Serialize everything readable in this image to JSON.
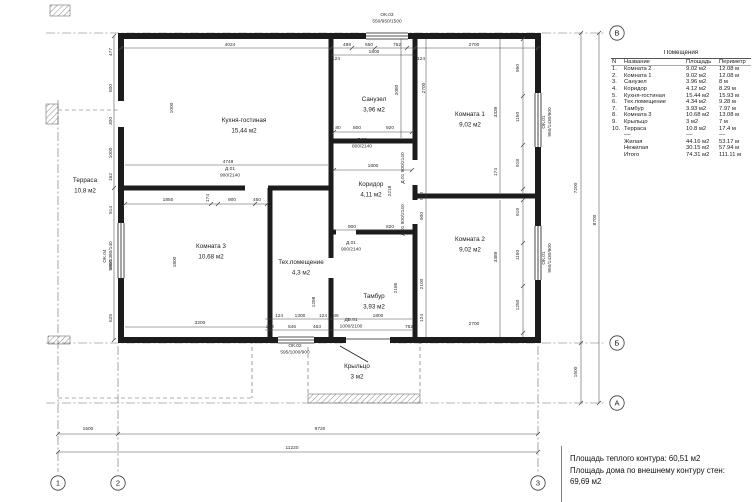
{
  "legend": {
    "title": "Помещения",
    "headers": {
      "num": "N",
      "name": "Название",
      "area": "Площадь",
      "perimeter": "Периметр"
    },
    "rows": [
      {
        "n": "1.",
        "name": "Комната 2",
        "area": "9.02 м2",
        "perimeter": "12.08 м"
      },
      {
        "n": "2.",
        "name": "Комната 1",
        "area": "9.02 м2",
        "perimeter": "12.08 м"
      },
      {
        "n": "3.",
        "name": "Санузел",
        "area": "3.96 м2",
        "perimeter": "8 м"
      },
      {
        "n": "4.",
        "name": "Коридор",
        "area": "4.12 м2",
        "perimeter": "8.29 м"
      },
      {
        "n": "5.",
        "name": "Кухня-гостиная",
        "area": "15.44 м2",
        "perimeter": "15.93 м"
      },
      {
        "n": "6.",
        "name": "Тех.помещение",
        "area": "4.34 м2",
        "perimeter": "9.28 м"
      },
      {
        "n": "7.",
        "name": "Тамбур",
        "area": "3.93 м2",
        "perimeter": "7.97 м"
      },
      {
        "n": "8.",
        "name": "Комната 3",
        "area": "10.68 м2",
        "perimeter": "13.08 м"
      },
      {
        "n": "9.",
        "name": "Крыльцо",
        "area": "3 м2",
        "perimeter": "7 м"
      },
      {
        "n": "10.",
        "name": "Терраса",
        "area": "10.8 м2",
        "perimeter": "17.4 м"
      }
    ],
    "separator": "––",
    "summary": [
      {
        "name": "Жилая",
        "area": "44.16 м2",
        "perimeter": "53.17 м"
      },
      {
        "name": "Нежилая",
        "area": "30.15 м2",
        "perimeter": "57.94 м"
      },
      {
        "name": "Итого",
        "area": "74.31 м2",
        "perimeter": "111.11 м"
      }
    ]
  },
  "footer": {
    "line1": "Площадь теплого контура: 60,51 м2",
    "line2": "Площадь дома по внешнему контуру стен:",
    "line3": "69,69 м2"
  },
  "plan": {
    "rooms": [
      {
        "name": "Кухня-гостиная",
        "area": "15,44 м2",
        "x": 244,
        "y": 122
      },
      {
        "name": "Санузел",
        "area": "3,96 м2",
        "x": 374,
        "y": 101
      },
      {
        "name": "Комната 1",
        "area": "9,02 м2",
        "x": 470,
        "y": 116
      },
      {
        "name": "Коридор",
        "area": "4,11 м2",
        "x": 371,
        "y": 186
      },
      {
        "name": "Комната 3",
        "area": "10,68 м2",
        "x": 211,
        "y": 248
      },
      {
        "name": "Тех.помещение",
        "area": "4,3 м2",
        "x": 301,
        "y": 264
      },
      {
        "name": "Тамбур",
        "area": "3,93 м2",
        "x": 374,
        "y": 298
      },
      {
        "name": "Комната 2",
        "area": "9,02 м2",
        "x": 470,
        "y": 241
      },
      {
        "name": "Терраса",
        "area": "10,8 м2",
        "x": 85,
        "y": 182
      },
      {
        "name": "Крыльцо",
        "area": "3 м2",
        "x": 357,
        "y": 368
      }
    ],
    "dimensions": [
      {
        "t": "4024",
        "x": 230,
        "y": 46
      },
      {
        "t": "498",
        "x": 347,
        "y": 46
      },
      {
        "t": "550",
        "x": 369,
        "y": 46
      },
      {
        "t": "752",
        "x": 397,
        "y": 46
      },
      {
        "t": "1800",
        "x": 374,
        "y": 53
      },
      {
        "t": "124",
        "x": 336,
        "y": 60
      },
      {
        "t": "124",
        "x": 421,
        "y": 60
      },
      {
        "t": "2700",
        "x": 474,
        "y": 46
      },
      {
        "t": "477",
        "x": 112,
        "y": 52,
        "r": 1
      },
      {
        "t": "600",
        "x": 112,
        "y": 88,
        "r": 1
      },
      {
        "t": "300",
        "x": 112,
        "y": 121,
        "r": 1
      },
      {
        "t": "1000",
        "x": 112,
        "y": 153,
        "r": 1
      },
      {
        "t": "162",
        "x": 112,
        "y": 177,
        "r": 1
      },
      {
        "t": "914",
        "x": 112,
        "y": 210,
        "r": 1
      },
      {
        "t": "1800",
        "x": 112,
        "y": 265,
        "r": 1
      },
      {
        "t": "625",
        "x": 112,
        "y": 318,
        "r": 1
      },
      {
        "t": "1000",
        "x": 173,
        "y": 108,
        "r": 1
      },
      {
        "t": "2080",
        "x": 398,
        "y": 90,
        "r": 1
      },
      {
        "t": "80",
        "x": 338,
        "y": 129
      },
      {
        "t": "800",
        "x": 357,
        "y": 129
      },
      {
        "t": "920",
        "x": 390,
        "y": 129
      },
      {
        "t": "2700",
        "x": 425,
        "y": 88,
        "r": 1
      },
      {
        "t": "3339",
        "x": 497,
        "y": 112,
        "r": 1
      },
      {
        "t": "950",
        "x": 519,
        "y": 68,
        "r": 1
      },
      {
        "t": "1150",
        "x": 519,
        "y": 117,
        "r": 1
      },
      {
        "t": "918",
        "x": 519,
        "y": 163,
        "r": 1
      },
      {
        "t": "174",
        "x": 497,
        "y": 172,
        "r": 1
      },
      {
        "t": "1800",
        "x": 373,
        "y": 167
      },
      {
        "t": "2218",
        "x": 391,
        "y": 191,
        "r": 1
      },
      {
        "t": "900",
        "x": 352,
        "y": 228
      },
      {
        "t": "820",
        "x": 390,
        "y": 228
      },
      {
        "t": "4748",
        "x": 228,
        "y": 163
      },
      {
        "t": "1850",
        "x": 168,
        "y": 201
      },
      {
        "t": "174",
        "x": 209,
        "y": 198,
        "r": 1
      },
      {
        "t": "900",
        "x": 232,
        "y": 201
      },
      {
        "t": "450",
        "x": 257,
        "y": 201
      },
      {
        "t": "1800",
        "x": 176,
        "y": 262,
        "r": 1
      },
      {
        "t": "3200",
        "x": 200,
        "y": 324
      },
      {
        "t": "1298",
        "x": 315,
        "y": 302,
        "r": 1
      },
      {
        "t": "124",
        "x": 279,
        "y": 317
      },
      {
        "t": "1300",
        "x": 300,
        "y": 317
      },
      {
        "t": "124",
        "x": 323,
        "y": 317
      },
      {
        "t": "262",
        "x": 270,
        "y": 328
      },
      {
        "t": "546",
        "x": 292,
        "y": 328
      },
      {
        "t": "463",
        "x": 317,
        "y": 328
      },
      {
        "t": "2185",
        "x": 397,
        "y": 288,
        "r": 1
      },
      {
        "t": "46",
        "x": 336,
        "y": 317
      },
      {
        "t": "1800",
        "x": 378,
        "y": 317
      },
      {
        "t": "762",
        "x": 409,
        "y": 328
      },
      {
        "t": "500",
        "x": 423,
        "y": 196,
        "r": 1
      },
      {
        "t": "900",
        "x": 423,
        "y": 216,
        "r": 1
      },
      {
        "t": "2100",
        "x": 423,
        "y": 284,
        "r": 1
      },
      {
        "t": "124",
        "x": 423,
        "y": 318,
        "r": 1
      },
      {
        "t": "3389",
        "x": 497,
        "y": 257,
        "r": 1
      },
      {
        "t": "919",
        "x": 519,
        "y": 212,
        "r": 1
      },
      {
        "t": "1150",
        "x": 519,
        "y": 255,
        "r": 1
      },
      {
        "t": "1250",
        "x": 519,
        "y": 305,
        "r": 1
      },
      {
        "t": "2700",
        "x": 474,
        "y": 325
      },
      {
        "t": "7200",
        "x": 577,
        "y": 188,
        "r": 1
      },
      {
        "t": "8700",
        "x": 596,
        "y": 220,
        "r": 1
      },
      {
        "t": "1500",
        "x": 577,
        "y": 372,
        "r": 1
      },
      {
        "t": "1500",
        "x": 88,
        "y": 430
      },
      {
        "t": "9720",
        "x": 320,
        "y": 430
      },
      {
        "t": "11220",
        "x": 292,
        "y": 449
      }
    ],
    "marks": [
      {
        "lines": [
          "ОК.03",
          "550/950/1500"
        ],
        "x": 387,
        "y": 16
      },
      {
        "lines": [
          "ОК.01",
          "950/1430/900"
        ],
        "x": 545,
        "y": 122,
        "r": 1
      },
      {
        "lines": [
          "ОК.01",
          "950/1430/900"
        ],
        "x": 545,
        "y": 258,
        "r": 1
      },
      {
        "lines": [
          "ОК.04",
          "900/1380/140"
        ],
        "x": 106,
        "y": 256,
        "r": 1
      },
      {
        "lines": [
          "ОК.02",
          "595/1000/900"
        ],
        "x": 295,
        "y": 347
      },
      {
        "lines": [
          "Д.02",
          "800/2140"
        ],
        "x": 362,
        "y": 141
      },
      {
        "lines": [
          "Д.01",
          "900/2140"
        ],
        "x": 230,
        "y": 170
      },
      {
        "lines": [
          "Д.01",
          "900/2140"
        ],
        "x": 351,
        "y": 244
      },
      {
        "lines": [
          "ДВ.01",
          "1000/2100"
        ],
        "x": 351,
        "y": 321
      },
      {
        "lines": [
          "Д.01 900/2140"
        ],
        "x": 404,
        "y": 168,
        "r": 1
      },
      {
        "lines": [
          "Д.01 900/2140"
        ],
        "x": 404,
        "y": 220,
        "r": 1
      }
    ],
    "axes": {
      "bottom": [
        {
          "label": "1",
          "x": 58,
          "y": 483
        },
        {
          "label": "2",
          "x": 118,
          "y": 483
        },
        {
          "label": "3",
          "x": 538,
          "y": 483
        }
      ],
      "right": [
        {
          "label": "В",
          "x": 617,
          "y": 33
        },
        {
          "label": "Б",
          "x": 617,
          "y": 343
        },
        {
          "label": "А",
          "x": 617,
          "y": 403
        }
      ]
    }
  }
}
